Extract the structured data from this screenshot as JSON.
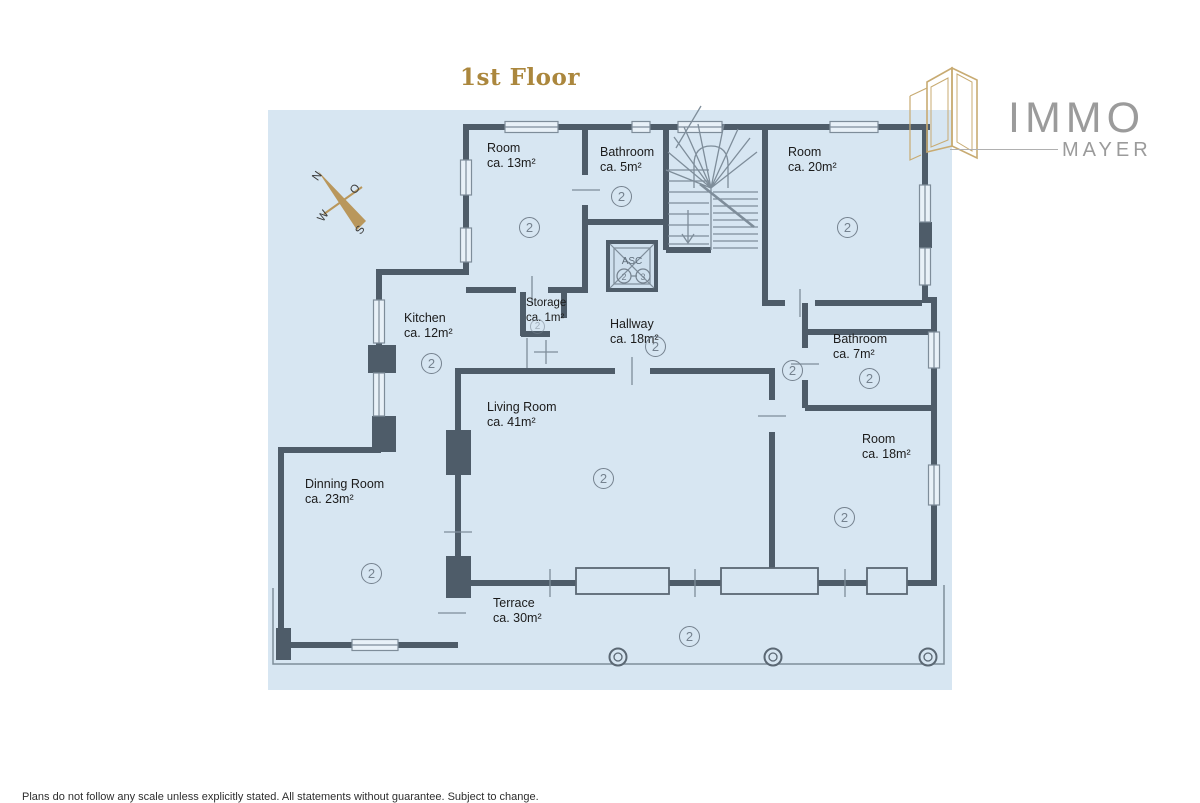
{
  "title": "1st Floor",
  "logo": {
    "name": "IMMO",
    "sub": "MAYER"
  },
  "compass": {
    "n": "N",
    "o": "O",
    "w": "W",
    "s": "S"
  },
  "floor_marker": "2",
  "elevator": {
    "label": "ASC",
    "floor_a": "2",
    "floor_b": "3"
  },
  "rooms": [
    {
      "name": "Room",
      "area": "ca. 13m²"
    },
    {
      "name": "Bathroom",
      "area": "ca. 5m²"
    },
    {
      "name": "Room",
      "area": "ca. 20m²"
    },
    {
      "name": "Kitchen",
      "area": "ca. 12m²"
    },
    {
      "name": "Storage",
      "area": "ca. 1m²"
    },
    {
      "name": "Hallway",
      "area": "ca. 18m²"
    },
    {
      "name": "Bathroom",
      "area": "ca. 7m²"
    },
    {
      "name": "Room",
      "area": "ca. 18m²"
    },
    {
      "name": "Living Room",
      "area": "ca. 41m²"
    },
    {
      "name": "Dinning Room",
      "area": "ca. 23m²"
    },
    {
      "name": "Terrace",
      "area": "ca. 30m²"
    }
  ],
  "footer": {
    "disclaimer": "Plans do not follow any scale unless explicitly stated. All statements without guarantee. Subject to change."
  },
  "colors": {
    "paper": "#d7e6f2",
    "wall": "#4e5c69",
    "thin_line": "#7e8d9a",
    "title_gold": "#ab873d",
    "needle_gold": "#b9975c",
    "logo_gray": "#9b9b9b"
  }
}
